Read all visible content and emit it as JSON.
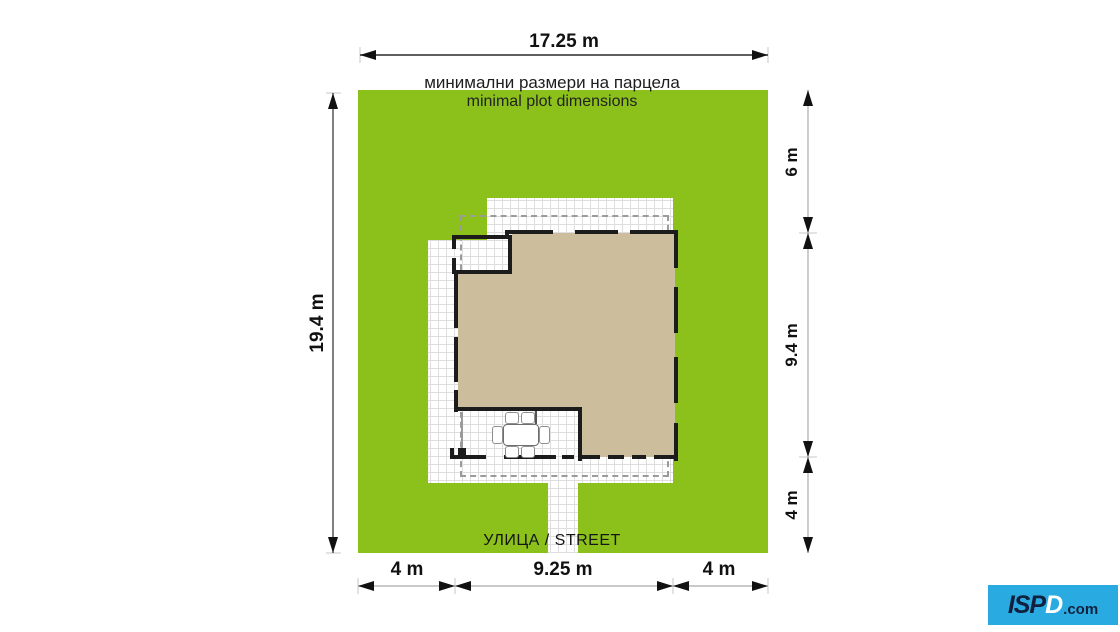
{
  "title": {
    "bg": "минимални размери на парцела",
    "en": "minimal plot dimensions"
  },
  "street_label": "УЛИЦА / STREET",
  "dimensions": {
    "top_width": "17.25 m",
    "left_height": "19.4 m",
    "right": [
      {
        "label": "6 m"
      },
      {
        "label": "9.4 m"
      },
      {
        "label": "4 m"
      }
    ],
    "bottom": [
      {
        "label": "4 m"
      },
      {
        "label": "9.25 m"
      },
      {
        "label": "4 m"
      }
    ]
  },
  "logo": {
    "p1": "ISP",
    "p2": "D",
    "suffix": ".com"
  },
  "colors": {
    "plot_green": "#8cc11c",
    "house_tan": "#ccbe9c",
    "wall": "#1c1c1c",
    "paving_grid": "#dedede",
    "roof_dash": "#9b9b9b",
    "dim_dark": "#2b2b2b",
    "dim_light": "#b8b8b8",
    "logo_blue": "#29abe2",
    "logo_navy": "#12203d"
  }
}
